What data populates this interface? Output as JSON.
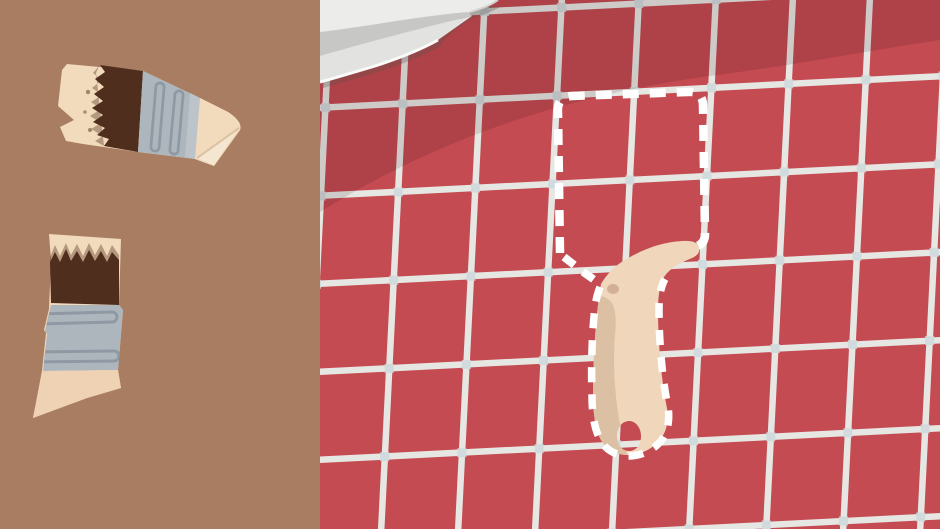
{
  "scene": {
    "name": "paintbrush-repair-puzzle",
    "description": "Flat cartoon illustration: two broken paintbrush fragments rest on a brown table at left; at right, a red tiled wall shows a white dashed target silhouette of the assembled brush with its beige handle already placed, and a white cloth draped over the top-left corner of the tiles.",
    "text_content": []
  },
  "palette": {
    "left-bg": "#a87d61",
    "tile-red": "#c44b51",
    "shade-overlay": "rgba(40,8,14,0.13)",
    "grout": "#e6e7e3",
    "grout-dot": "#ccd8dc",
    "cloth-light": "#ececea",
    "cloth-fold": "#c7c7c5",
    "cloth-lower": "#e2e2e0",
    "cloth-rim": "#fafaf8",
    "cloth-edge": "#d2d2d0",
    "cloth-shadow": "rgba(90,80,75,0.30)",
    "outline-white": "#ffffff",
    "bristle-cream": "#f2dabc",
    "paint-dark": "#502e1d",
    "paint-fuzz": "#6b4a35",
    "ferrule-gray": "#adb6bd",
    "ferrule-ridge": "#8f99a3",
    "ferrule-highlight": "#bcc4ca",
    "handle-cream": "#efd2b3",
    "handle-placed": "#f0d6ba",
    "handle-shadow": "#dcc0a4",
    "handle-fold": "#f4e6d1",
    "crease": "#dcc2a4",
    "blemish": "#c8a188"
  },
  "left_panel": {
    "role": "workbench with broken brush pieces",
    "pieces": [
      {
        "id": "brush-head-fragment",
        "parts": [
          "bristle-tip",
          "dried-paint",
          "ferrule-band",
          "handle-stub"
        ],
        "state": "loose"
      },
      {
        "id": "brush-ferrule-fragment",
        "parts": [
          "bristle-tip",
          "dried-paint",
          "ferrule-band",
          "handle-stub"
        ],
        "state": "loose"
      }
    ]
  },
  "right_panel": {
    "role": "red tiled wall with assembly target",
    "grid": {
      "vertical_base_x": [
        -3,
        74,
        151,
        228,
        305,
        382,
        459,
        536,
        613
      ],
      "horizontal_base_y": [
        4,
        92,
        180,
        268,
        356,
        444,
        532
      ],
      "v_top_shift": 14,
      "v_bottom_shift": -13,
      "h_left_shift": 16,
      "h_right_shift": -16,
      "line_width": 6.5,
      "dot_size": 9,
      "panel_width": 620,
      "panel_height": 529
    },
    "objects": [
      {
        "id": "cloth-corner",
        "state": "draped"
      },
      {
        "id": "target-outline",
        "style": "white-dashed",
        "shape": "paintbrush-silhouette"
      },
      {
        "id": "brush-handle-placed",
        "state": "snapped-into-outline",
        "detail": "hang-hole shows tiles through"
      }
    ]
  }
}
